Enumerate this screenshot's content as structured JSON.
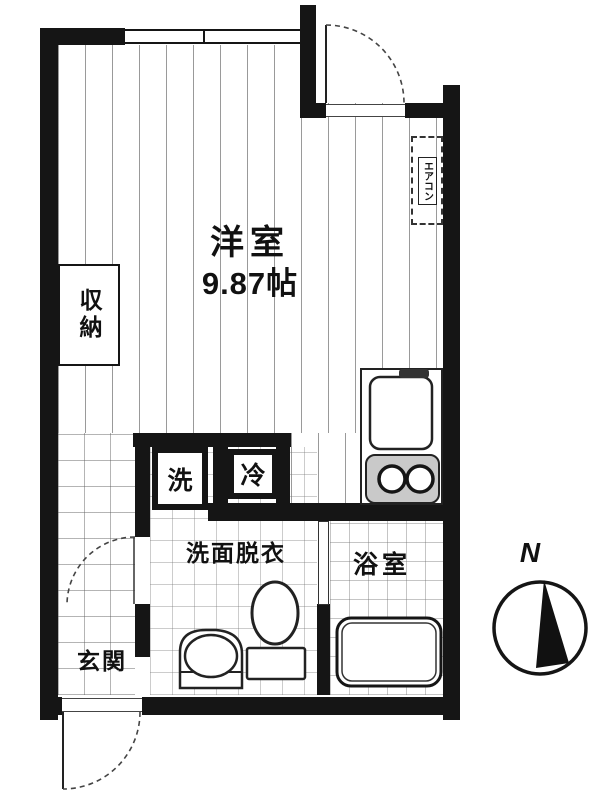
{
  "plan": {
    "room_label": "洋室",
    "room_area": "9.87帖",
    "closet_label": "収納",
    "washer_label": "洗",
    "fridge_label": "冷",
    "washroom_label": "洗面脱衣",
    "entrance_label": "玄関",
    "bathroom_label": "浴室",
    "aircon_label": "エアコン",
    "compass_north_label": "N"
  },
  "colors": {
    "wall": "#151515",
    "floor_line": "#555555",
    "background": "#ffffff"
  }
}
